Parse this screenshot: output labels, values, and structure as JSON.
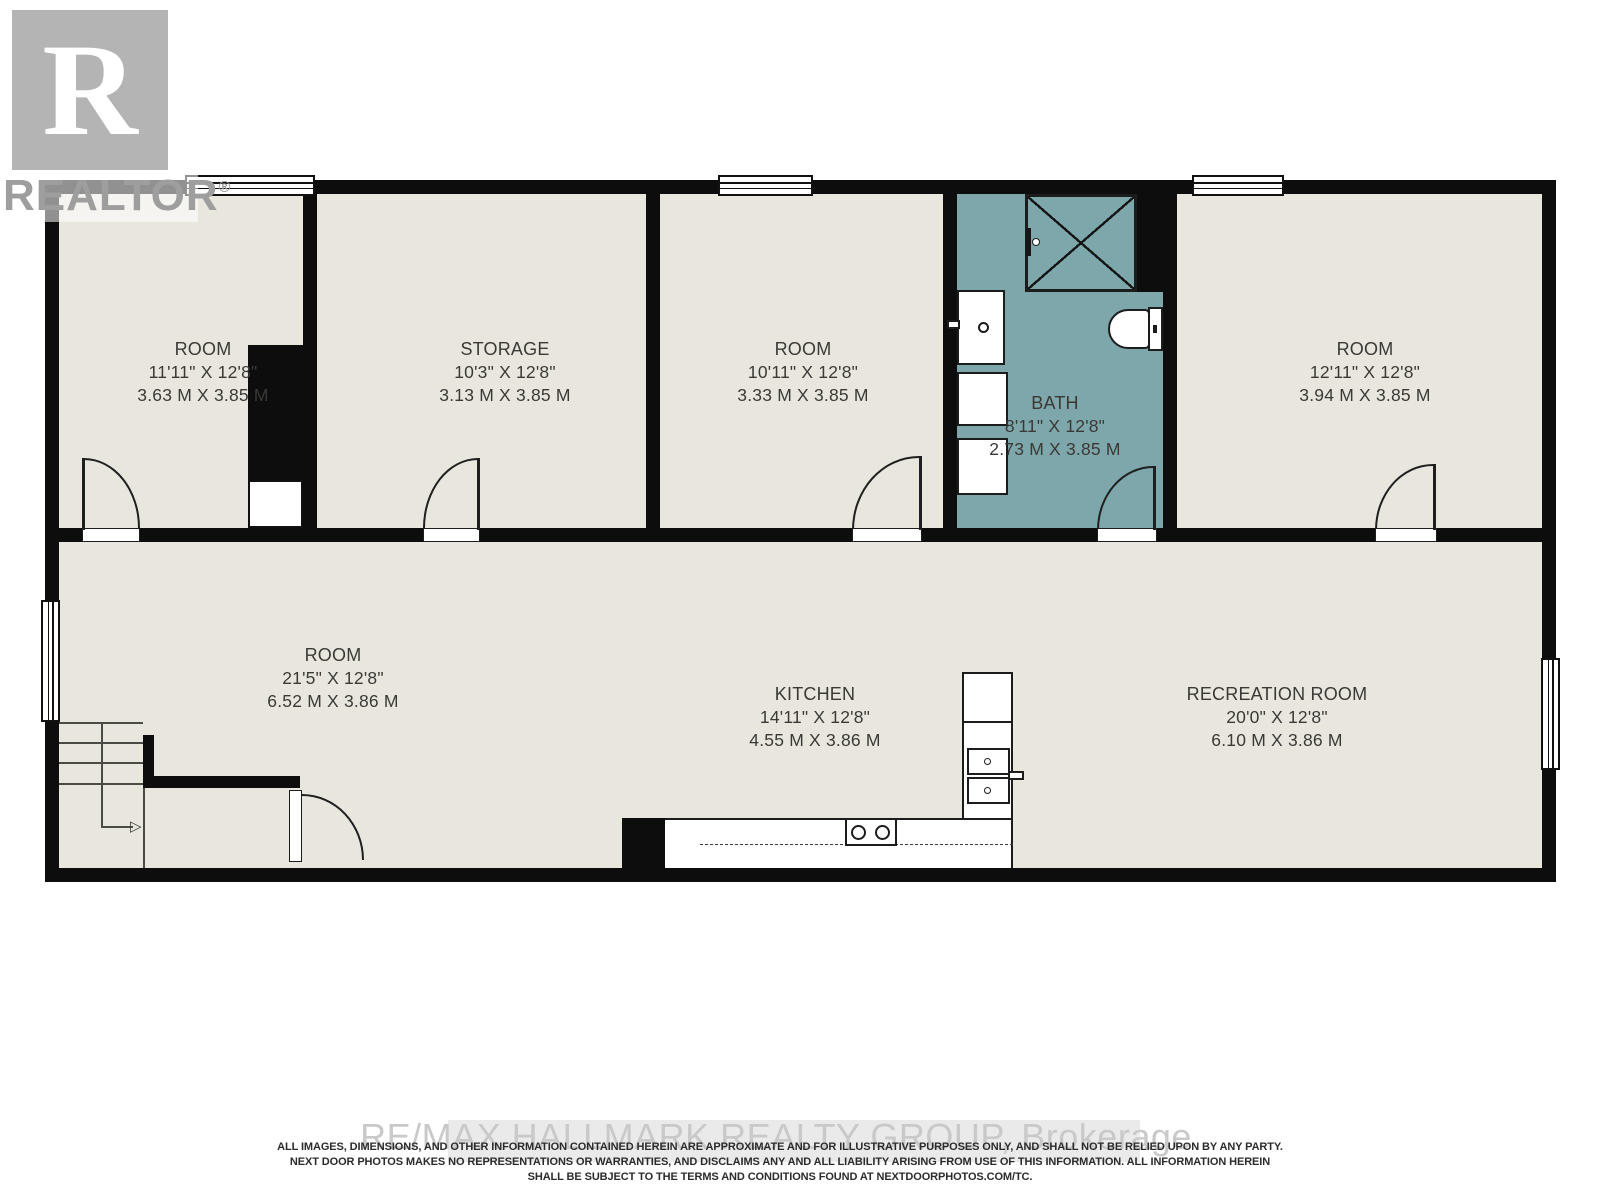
{
  "branding": {
    "logo_letter": "R",
    "logo_label": "REALTOR",
    "logo_reg": "®",
    "watermark": "RE/MAX HALLMARK REALTY GROUP, Brokerage"
  },
  "rooms": [
    {
      "name": "ROOM",
      "imperial": "11'11\" X 12'8\"",
      "metric": "3.63 M X 3.85 M"
    },
    {
      "name": "STORAGE",
      "imperial": "10'3\" X 12'8\"",
      "metric": "3.13 M X 3.85 M"
    },
    {
      "name": "ROOM",
      "imperial": "10'11\" X 12'8\"",
      "metric": "3.33 M X 3.85 M"
    },
    {
      "name": "BATH",
      "imperial": "8'11\" X 12'8\"",
      "metric": "2.73 M X 3.85 M"
    },
    {
      "name": "ROOM",
      "imperial": "12'11\" X 12'8\"",
      "metric": "3.94 M X 3.85 M"
    },
    {
      "name": "ROOM",
      "imperial": "21'5\" X 12'8\"",
      "metric": "6.52 M X 3.86 M"
    },
    {
      "name": "KITCHEN",
      "imperial": "14'11\" X 12'8\"",
      "metric": "4.55 M X 3.86 M"
    },
    {
      "name": "RECREATION ROOM",
      "imperial": "20'0\" X 12'8\"",
      "metric": "6.10 M X 3.86 M"
    }
  ],
  "icons": {
    "stair_direction_arrow": "▷"
  },
  "disclaimer": {
    "line1": "ALL IMAGES, DIMENSIONS, AND OTHER INFORMATION CONTAINED HEREIN ARE APPROXIMATE AND FOR ILLUSTRATIVE PURPOSES ONLY, AND SHALL NOT BE RELIED UPON BY ANY PARTY.",
    "line2": "NEXT DOOR PHOTOS MAKES NO REPRESENTATIONS OR WARRANTIES, AND DISCLAIMS ANY AND ALL LIABILITY ARISING FROM USE OF THIS INFORMATION. ALL INFORMATION HEREIN",
    "line3": "SHALL BE SUBJECT TO THE TERMS AND CONDITIONS FOUND AT NEXTDOORPHOTOS.COM/TC."
  },
  "colors": {
    "wall": "#0d0d0d",
    "floor": "#e9e7dd",
    "bath": "#7da7aa",
    "label": "#3a3936",
    "logo-gray": "#b4b4b4",
    "logo-text": "#9e9e9e",
    "watermark-gray": "#c9c9c9"
  }
}
